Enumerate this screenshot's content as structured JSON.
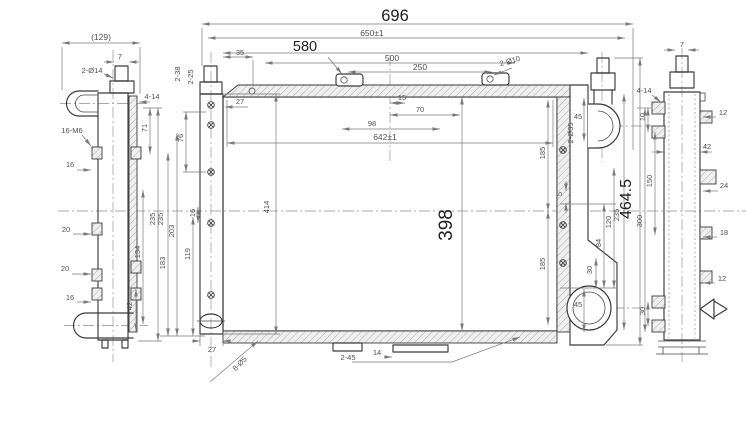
{
  "meta": {
    "bg": "#ffffff",
    "line_color": "#3a3a3a",
    "dim_color": "#7a7a7a",
    "accent_text_color": "#1f1f1f"
  },
  "lv": {
    "w129": "(129)",
    "w7": "7",
    "h2d14": "2-Ø14",
    "h414": "4-14",
    "m6": "16-M6",
    "o16t": "16",
    "o20a": "20",
    "o20b": "20",
    "o16b": "16",
    "v71": "71",
    "v235": "235",
    "v134": "134",
    "v42": "42"
  },
  "mv": {
    "w696": "696",
    "w650": "650±1",
    "w580": "580",
    "w500": "500",
    "w250": "250",
    "h2d10": "2-Ø10",
    "o35": "35",
    "n238": "2-38",
    "n225": "2-25",
    "o27t": "27",
    "o15": "15",
    "o70": "70",
    "o98": "98",
    "w642": "642±1",
    "h398": "398",
    "h414": "414",
    "v203": "203",
    "v183": "183",
    "v119": "119",
    "v76": "76",
    "v16": "16",
    "v235l": "235",
    "h2d35": "2-Ø35",
    "o45t": "45",
    "v185u": "185",
    "v185l": "185",
    "v5": "5",
    "v84": "84",
    "v30": "30",
    "v120": "120",
    "v235r": "235",
    "h4645": "464.5",
    "o45b": "45",
    "o27b": "27",
    "h8d5": "8-Ø5",
    "n245": "2-45",
    "o14": "14"
  },
  "rv": {
    "w7": "7",
    "h414": "4-14",
    "v10": "10",
    "o12t": "12",
    "w42": "42",
    "v150": "150",
    "o24": "24",
    "v300": "300",
    "o18": "18",
    "o12b": "12",
    "v30": "30"
  }
}
